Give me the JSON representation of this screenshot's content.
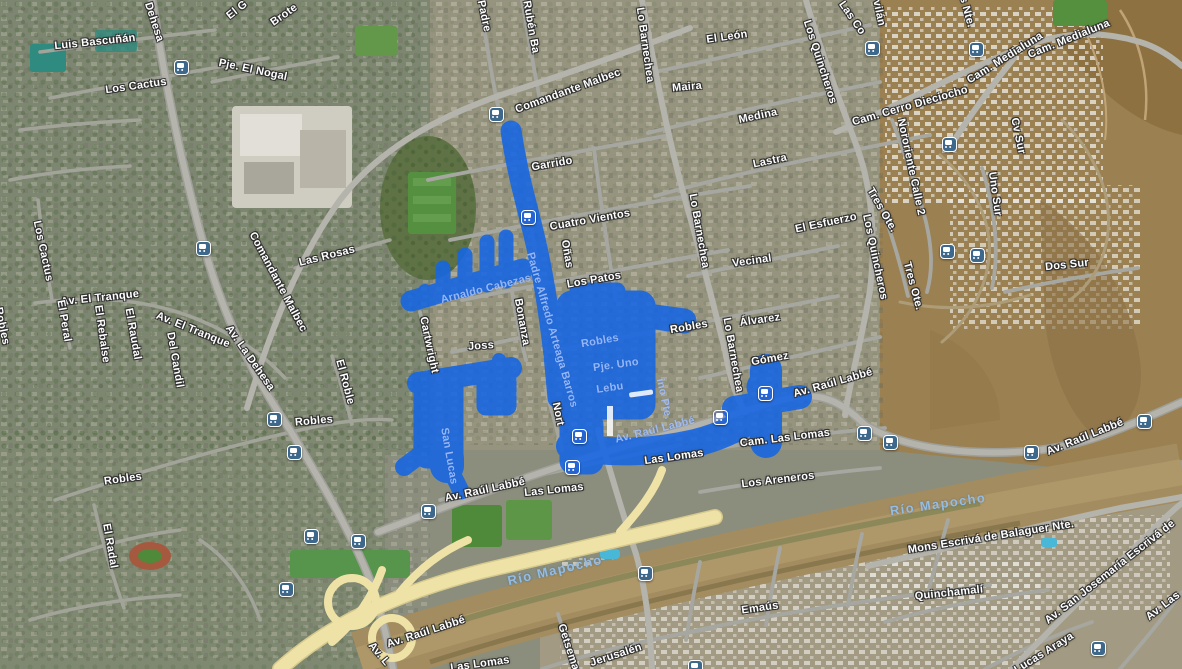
{
  "map": {
    "overlay": {
      "name": "highlighted-area",
      "color": "#1566e4",
      "opacity": 0.88
    },
    "colors": {
      "transit_icon_bg": "#3d688c",
      "street_label": "#ffffff",
      "water_label": "#93bce4",
      "overlay_label": "#aac6fc",
      "highway_yellow": "#efe2a6"
    },
    "labels": [
      {
        "text": "Luis Bascuñán",
        "x": 95,
        "y": 42,
        "rot": -6,
        "kind": "street"
      },
      {
        "text": "Los Cactus",
        "x": 136,
        "y": 86,
        "rot": -8,
        "kind": "street"
      },
      {
        "text": "Pje. El Nogal",
        "x": 253,
        "y": 70,
        "rot": 12,
        "kind": "street"
      },
      {
        "text": "Dehesa",
        "x": 154,
        "y": 22,
        "rot": 72,
        "kind": "street"
      },
      {
        "text": "El G",
        "x": 237,
        "y": 10,
        "rot": -38,
        "kind": "street"
      },
      {
        "text": "Brote",
        "x": 284,
        "y": 15,
        "rot": -35,
        "kind": "street"
      },
      {
        "text": "Padre",
        "x": 484,
        "y": 16,
        "rot": 78,
        "kind": "street"
      },
      {
        "text": "Rubén Ba",
        "x": 531,
        "y": 27,
        "rot": 80,
        "kind": "street"
      },
      {
        "text": "Comandante Malbec",
        "x": 568,
        "y": 91,
        "rot": -20,
        "kind": "street"
      },
      {
        "text": "Lo Barnechea",
        "x": 645,
        "y": 45,
        "rot": 82,
        "kind": "street"
      },
      {
        "text": "El León",
        "x": 727,
        "y": 37,
        "rot": -8,
        "kind": "street"
      },
      {
        "text": "Maira",
        "x": 687,
        "y": 87,
        "rot": -5,
        "kind": "street"
      },
      {
        "text": "Medina",
        "x": 758,
        "y": 116,
        "rot": -12,
        "kind": "street"
      },
      {
        "text": "Lastra",
        "x": 770,
        "y": 161,
        "rot": -12,
        "kind": "street"
      },
      {
        "text": "Los Quincheros",
        "x": 820,
        "y": 62,
        "rot": 72,
        "kind": "street"
      },
      {
        "text": "Las Co",
        "x": 852,
        "y": 18,
        "rot": 55,
        "kind": "street"
      },
      {
        "text": "vilán",
        "x": 879,
        "y": 13,
        "rot": 78,
        "kind": "street"
      },
      {
        "text": "s Nte.",
        "x": 967,
        "y": 12,
        "rot": 75,
        "kind": "street"
      },
      {
        "text": "Cam. Medialuna",
        "x": 1005,
        "y": 58,
        "rot": -32,
        "kind": "street"
      },
      {
        "text": "Cam. Medialuna",
        "x": 1069,
        "y": 39,
        "rot": -22,
        "kind": "street"
      },
      {
        "text": "Cam. Cerro Dieciocho",
        "x": 910,
        "y": 106,
        "rot": -16,
        "kind": "street"
      },
      {
        "text": "Cv Sur",
        "x": 1018,
        "y": 136,
        "rot": 78,
        "kind": "street"
      },
      {
        "text": "Nororiente Calle 2",
        "x": 911,
        "y": 167,
        "rot": 78,
        "kind": "street"
      },
      {
        "text": "Uno Sur",
        "x": 995,
        "y": 194,
        "rot": 82,
        "kind": "street"
      },
      {
        "text": "Tres Ote.",
        "x": 882,
        "y": 210,
        "rot": 60,
        "kind": "street"
      },
      {
        "text": "Tres Ote.",
        "x": 913,
        "y": 286,
        "rot": 75,
        "kind": "street"
      },
      {
        "text": "Dos Sur",
        "x": 1067,
        "y": 265,
        "rot": -6,
        "kind": "street"
      },
      {
        "text": "Los Quincheros",
        "x": 875,
        "y": 257,
        "rot": 78,
        "kind": "street"
      },
      {
        "text": "Los Cactus",
        "x": 43,
        "y": 251,
        "rot": 78,
        "kind": "street"
      },
      {
        "text": "Av. El Tranque",
        "x": 100,
        "y": 298,
        "rot": -6,
        "kind": "street"
      },
      {
        "text": "Av. El Tranque",
        "x": 193,
        "y": 330,
        "rot": 22,
        "kind": "street"
      },
      {
        "text": "El Peral",
        "x": 64,
        "y": 321,
        "rot": 80,
        "kind": "street"
      },
      {
        "text": "El Rebalse",
        "x": 102,
        "y": 334,
        "rot": 82,
        "kind": "street"
      },
      {
        "text": "El Raudal",
        "x": 133,
        "y": 334,
        "rot": 80,
        "kind": "street"
      },
      {
        "text": "Del Candil",
        "x": 175,
        "y": 360,
        "rot": 80,
        "kind": "street"
      },
      {
        "text": "Av. La Dehesa",
        "x": 250,
        "y": 358,
        "rot": 55,
        "kind": "street"
      },
      {
        "text": "Comandante Malbec",
        "x": 278,
        "y": 282,
        "rot": 62,
        "kind": "street"
      },
      {
        "text": "Las Rosas",
        "x": 327,
        "y": 256,
        "rot": -14,
        "kind": "street"
      },
      {
        "text": "El Roble",
        "x": 345,
        "y": 382,
        "rot": 75,
        "kind": "street"
      },
      {
        "text": "Robles",
        "x": 2,
        "y": 326,
        "rot": 78,
        "kind": "street"
      },
      {
        "text": "Garrido",
        "x": 552,
        "y": 164,
        "rot": -10,
        "kind": "street"
      },
      {
        "text": "Cuatro Vientos",
        "x": 590,
        "y": 220,
        "rot": -10,
        "kind": "street"
      },
      {
        "text": "Oñas",
        "x": 567,
        "y": 254,
        "rot": 80,
        "kind": "street"
      },
      {
        "text": "Los Patos",
        "x": 594,
        "y": 280,
        "rot": -10,
        "kind": "street"
      },
      {
        "text": "Lo Barnechea",
        "x": 699,
        "y": 231,
        "rot": 80,
        "kind": "street"
      },
      {
        "text": "Vecinal",
        "x": 752,
        "y": 261,
        "rot": -8,
        "kind": "street"
      },
      {
        "text": "El Esfuerzo",
        "x": 826,
        "y": 223,
        "rot": -12,
        "kind": "street"
      },
      {
        "text": "Robles",
        "x": 689,
        "y": 327,
        "rot": -10,
        "kind": "street"
      },
      {
        "text": "Álvarez",
        "x": 760,
        "y": 320,
        "rot": -8,
        "kind": "street"
      },
      {
        "text": "Lo Barnechea",
        "x": 733,
        "y": 355,
        "rot": 80,
        "kind": "street"
      },
      {
        "text": "Gómez",
        "x": 770,
        "y": 359,
        "rot": -10,
        "kind": "street"
      },
      {
        "text": "Cartwright",
        "x": 429,
        "y": 345,
        "rot": 78,
        "kind": "street"
      },
      {
        "text": "Joss",
        "x": 481,
        "y": 346,
        "rot": -4,
        "kind": "street"
      },
      {
        "text": "Bonanza",
        "x": 522,
        "y": 322,
        "rot": 80,
        "kind": "street"
      },
      {
        "text": "Nort",
        "x": 558,
        "y": 414,
        "rot": 78,
        "kind": "street"
      },
      {
        "text": "Robles",
        "x": 314,
        "y": 421,
        "rot": -5,
        "kind": "street"
      },
      {
        "text": "Robles",
        "x": 123,
        "y": 479,
        "rot": -8,
        "kind": "street"
      },
      {
        "text": "El Radal",
        "x": 110,
        "y": 546,
        "rot": 80,
        "kind": "street"
      },
      {
        "text": "Av. Raúl Labbé",
        "x": 485,
        "y": 490,
        "rot": -12,
        "kind": "street"
      },
      {
        "text": "Las Lomas",
        "x": 554,
        "y": 490,
        "rot": -6,
        "kind": "street"
      },
      {
        "text": "Las Lomas",
        "x": 674,
        "y": 457,
        "rot": -8,
        "kind": "street"
      },
      {
        "text": "Cam. Las Lomas",
        "x": 785,
        "y": 438,
        "rot": -7,
        "kind": "street"
      },
      {
        "text": "Los Areneros",
        "x": 778,
        "y": 480,
        "rot": -7,
        "kind": "street"
      },
      {
        "text": "Av. Raúl Labbé",
        "x": 833,
        "y": 383,
        "rot": -16,
        "kind": "street"
      },
      {
        "text": "Av. Raúl Labbé",
        "x": 1085,
        "y": 437,
        "rot": -22,
        "kind": "street"
      },
      {
        "text": "Av. L",
        "x": 379,
        "y": 654,
        "rot": 50,
        "kind": "street"
      },
      {
        "text": "Av. Raúl Labbé",
        "x": 426,
        "y": 632,
        "rot": -18,
        "kind": "street"
      },
      {
        "text": "Las Lomas",
        "x": 480,
        "y": 664,
        "rot": -8,
        "kind": "street"
      },
      {
        "text": "Emaús",
        "x": 760,
        "y": 608,
        "rot": -8,
        "kind": "street"
      },
      {
        "text": "Jerusalén",
        "x": 616,
        "y": 655,
        "rot": -18,
        "kind": "street"
      },
      {
        "text": "Getsemaní",
        "x": 570,
        "y": 652,
        "rot": 72,
        "kind": "street"
      },
      {
        "text": "Mons Escrivá de Balaguer Nte.",
        "x": 991,
        "y": 537,
        "rot": -9,
        "kind": "street"
      },
      {
        "text": "Quinchamalí",
        "x": 949,
        "y": 593,
        "rot": -6,
        "kind": "street"
      },
      {
        "text": "Av. San Josemaría Escrivá de",
        "x": 1110,
        "y": 572,
        "rot": -38,
        "kind": "street"
      },
      {
        "text": "Av. Las",
        "x": 1163,
        "y": 606,
        "rot": -38,
        "kind": "street"
      },
      {
        "text": "Lucas Araya",
        "x": 1044,
        "y": 653,
        "rot": -32,
        "kind": "street"
      },
      {
        "text": "Río Mapocho",
        "x": 555,
        "y": 570,
        "rot": -13,
        "kind": "water"
      },
      {
        "text": "Río Mapocho",
        "x": 938,
        "y": 504,
        "rot": -8,
        "kind": "water"
      },
      {
        "text": "Arnaldo Cabezas",
        "x": 486,
        "y": 289,
        "rot": -14,
        "kind": "overlay"
      },
      {
        "text": "Padre Alfredo Arteaga Barros",
        "x": 552,
        "y": 330,
        "rot": 74,
        "kind": "overlay"
      },
      {
        "text": "Robles",
        "x": 600,
        "y": 341,
        "rot": -10,
        "kind": "overlay"
      },
      {
        "text": "Pje. Uno",
        "x": 616,
        "y": 365,
        "rot": -8,
        "kind": "overlay"
      },
      {
        "text": "Lebu",
        "x": 610,
        "y": 388,
        "rot": -8,
        "kind": "overlay"
      },
      {
        "text": "ino Pte.",
        "x": 664,
        "y": 399,
        "rot": 78,
        "kind": "overlay"
      },
      {
        "text": "San Lucas",
        "x": 449,
        "y": 456,
        "rot": 80,
        "kind": "overlay"
      },
      {
        "text": "Av. Raúl Labbé",
        "x": 655,
        "y": 430,
        "rot": -14,
        "kind": "overlay"
      }
    ],
    "transit_stops": [
      {
        "x": 180,
        "y": 66,
        "on_overlay": false
      },
      {
        "x": 202,
        "y": 247,
        "on_overlay": false
      },
      {
        "x": 495,
        "y": 113,
        "on_overlay": false
      },
      {
        "x": 871,
        "y": 47,
        "on_overlay": false
      },
      {
        "x": 975,
        "y": 48,
        "on_overlay": false
      },
      {
        "x": 948,
        "y": 143,
        "on_overlay": false
      },
      {
        "x": 946,
        "y": 250,
        "on_overlay": false
      },
      {
        "x": 976,
        "y": 254,
        "on_overlay": false
      },
      {
        "x": 273,
        "y": 418,
        "on_overlay": false
      },
      {
        "x": 293,
        "y": 451,
        "on_overlay": false
      },
      {
        "x": 310,
        "y": 535,
        "on_overlay": false
      },
      {
        "x": 357,
        "y": 540,
        "on_overlay": false
      },
      {
        "x": 285,
        "y": 588,
        "on_overlay": false
      },
      {
        "x": 427,
        "y": 510,
        "on_overlay": false
      },
      {
        "x": 644,
        "y": 572,
        "on_overlay": false
      },
      {
        "x": 694,
        "y": 666,
        "on_overlay": false
      },
      {
        "x": 863,
        "y": 432,
        "on_overlay": false
      },
      {
        "x": 889,
        "y": 441,
        "on_overlay": false
      },
      {
        "x": 1030,
        "y": 451,
        "on_overlay": false
      },
      {
        "x": 1143,
        "y": 420,
        "on_overlay": false
      },
      {
        "x": 1097,
        "y": 647,
        "on_overlay": false
      },
      {
        "x": 527,
        "y": 216,
        "on_overlay": true
      },
      {
        "x": 578,
        "y": 435,
        "on_overlay": true
      },
      {
        "x": 571,
        "y": 466,
        "on_overlay": true
      },
      {
        "x": 719,
        "y": 416,
        "on_overlay": true
      },
      {
        "x": 764,
        "y": 392,
        "on_overlay": true
      }
    ]
  }
}
